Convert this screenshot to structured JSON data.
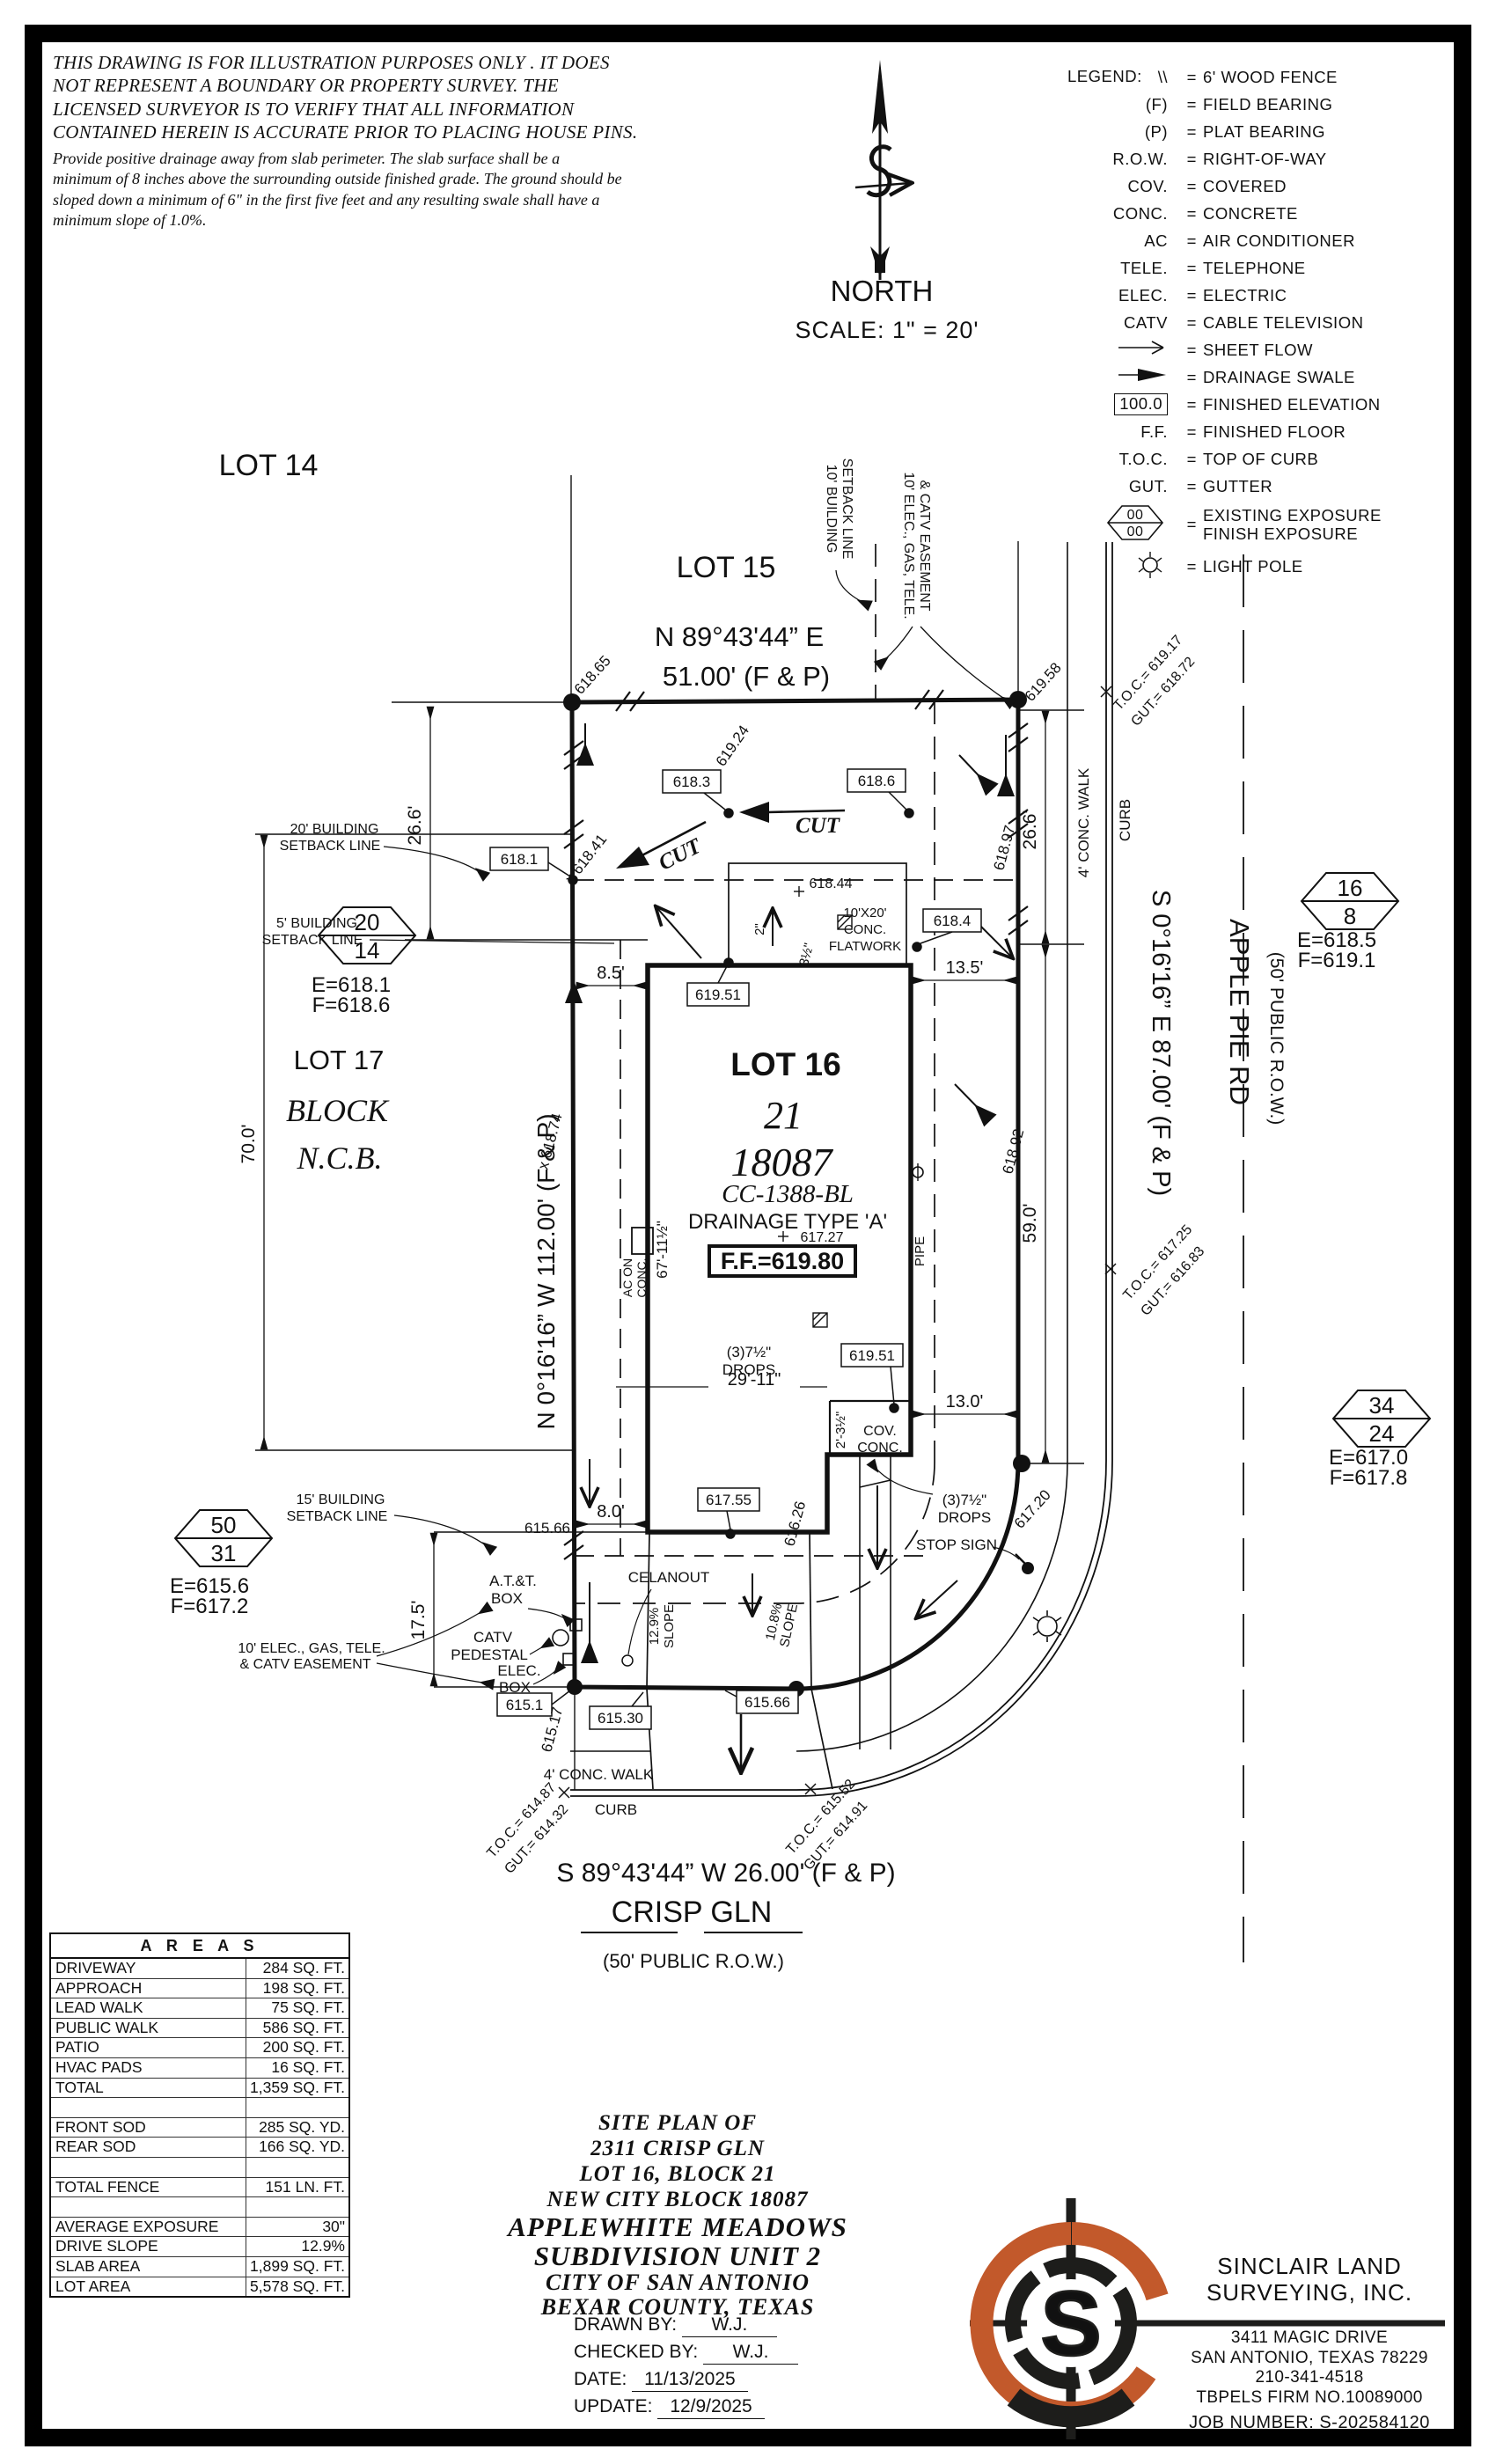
{
  "disclaimer": {
    "para1": "THIS DRAWING IS FOR ILLUSTRATION PURPOSES ONLY . IT DOES\nNOT REPRESENT A BOUNDARY OR PROPERTY SURVEY. THE\nLICENSED SURVEYOR IS TO VERIFY THAT ALL INFORMATION\nCONTAINED HEREIN IS ACCURATE PRIOR TO PLACING HOUSE PINS.",
    "para2": "Provide positive drainage away from slab perimeter. The slab surface shall be a\nminimum of 8 inches above the surrounding outside finished grade. The ground should be\nsloped down a minimum of 6\" in the first five feet and any resulting swale shall have a\nminimum slope of 1.0%."
  },
  "north": {
    "label": "NORTH",
    "scale": "SCALE: 1\" = 20'"
  },
  "legend": {
    "title": "LEGEND:",
    "eq": "=",
    "items": [
      {
        "sym": "\\\\",
        "desc": "6' WOOD FENCE"
      },
      {
        "sym": "(F)",
        "desc": "FIELD BEARING"
      },
      {
        "sym": "(P)",
        "desc": "PLAT BEARING"
      },
      {
        "sym": "R.O.W.",
        "desc": "RIGHT-OF-WAY"
      },
      {
        "sym": "COV.",
        "desc": "COVERED"
      },
      {
        "sym": "CONC.",
        "desc": "CONCRETE"
      },
      {
        "sym": "AC",
        "desc": "AIR CONDITIONER"
      },
      {
        "sym": "TELE.",
        "desc": "TELEPHONE"
      },
      {
        "sym": "ELEC.",
        "desc": "ELECTRIC"
      },
      {
        "sym": "CATV",
        "desc": "CABLE TELEVISION"
      },
      {
        "sym": "",
        "desc": "SHEET FLOW"
      },
      {
        "sym": "",
        "desc": "DRAINAGE SWALE"
      },
      {
        "sym": "100.0",
        "desc": "FINISHED ELEVATION"
      },
      {
        "sym": "F.F.",
        "desc": "FINISHED FLOOR"
      },
      {
        "sym": "T.O.C.",
        "desc": "TOP OF CURB"
      },
      {
        "sym": "GUT.",
        "desc": "GUTTER"
      },
      {
        "sym": "00",
        "sym2": "00",
        "desc": "EXISTING EXPOSURE",
        "desc2": "FINISH EXPOSURE"
      },
      {
        "sym": "",
        "desc": "LIGHT POLE"
      }
    ]
  },
  "plan": {
    "lot14": "LOT 14",
    "lot15": "LOT 15",
    "lot17": "LOT 17",
    "block_word": "BLOCK",
    "ncb_word": "N.C.B.",
    "lot16": "LOT 16",
    "block_num": "21",
    "ncb_num": "18087",
    "cc": "CC-1388-BL",
    "drainage_type": "DRAINAGE TYPE 'A'",
    "ff_spot": "617.27",
    "ff_box": "F.F.=619.80",
    "bearing_top1": "N 89°43'44” E",
    "bearing_top2": "51.00' (F & P)",
    "bearing_left": "N 0°16'16” W  112.00' (F & P)",
    "bearing_right": "S 0°16'16” E 87.00' (F & P)",
    "bearing_bottom": "S 89°43'44” W 26.00' (F & P)",
    "street_right1": "APPLE PIE RD",
    "street_right2": "(50' PUBLIC R.O.W.)",
    "street_bottom1": "CRISP GLN",
    "street_bottom2": "(50' PUBLIC R.O.W.)",
    "setback20_l1": "20' BUILDING",
    "setback20_l2": "SETBACK LINE",
    "setback5_l1": "5' BUILDING",
    "setback5_l2": "SETBACK LINE",
    "setback15_l1": "15' BUILDING",
    "setback15_l2": "SETBACK LINE",
    "setback10_l1": "10' BUILDING",
    "setback10_l2": "SETBACK LINE",
    "easement_top_l1": "10' ELEC., GAS, TELE.",
    "easement_top_l2": "& CATV EASEMENT",
    "easement_bottom_l1": "10' ELEC., GAS, TELE.",
    "easement_bottom_l2": "& CATV EASEMENT",
    "hex1_top": "20",
    "hex1_bot": "14",
    "hex1_e": "E=618.1",
    "hex1_f": "F=618.6",
    "hex2_top": "16",
    "hex2_bot": "8",
    "hex2_e": "E=618.5",
    "hex2_f": "F=619.1",
    "hex3_top": "34",
    "hex3_bot": "24",
    "hex3_e": "E=617.0",
    "hex3_f": "F=617.8",
    "hex4_top": "50",
    "hex4_bot": "31",
    "hex4_e": "E=615.6",
    "hex4_f": "F=617.2",
    "dim_26_6_left": "26.6'",
    "dim_26_6_right": "26.6'",
    "dim_70": "70.0'",
    "dim_59": "59.0'",
    "dim_17_5": "17.5'",
    "dim_8_5": "8.5'",
    "dim_13_5": "13.5'",
    "dim_8_0": "8.0'",
    "dim_13_0": "13.0'",
    "dim_29_11": "29'-11\"",
    "dim_67": "67'-11½\"",
    "dim_cov": "2'-3½\"",
    "flat_2": "2\"",
    "flat_3h": "3½\"",
    "el_618_65": "618.65",
    "el_619_58": "619.58",
    "el_619_24": "619.24",
    "el_618_41": "x 618.41",
    "el_618_97": "618.97",
    "el_618_74": "x 618.74",
    "el_618_92": "618.92",
    "el_618_44": "618.44",
    "el_616_26": "616.26",
    "el_617_20": "617.20",
    "el_615_17": "615.17",
    "el_615_66_txt": "615.66",
    "box_618_1": "618.1",
    "box_618_3": "618.3",
    "box_618_6": "618.6",
    "box_618_4": "618.4",
    "box_619_51a": "619.51",
    "box_619_51b": "619.51",
    "box_617_55": "617.55",
    "box_615_1": "615.1",
    "box_615_30": "615.30",
    "box_615_66": "615.66",
    "toc_tr1": "T.O.C.= 619.17",
    "toc_tr2": "GUT.= 618.72",
    "toc_r1": "T.O.C.= 617.25",
    "toc_r2": "GUT.= 616.83",
    "toc_bl1": "T.O.C.= 614.87",
    "toc_bl2": "GUT.= 614.32",
    "toc_br1": "T.O.C.= 615.52",
    "toc_br2": "GUT.= 614.91",
    "cut1": "CUT",
    "cut2": "CUT",
    "flatwork_l1": "10'X20'",
    "flatwork_l2": "CONC.",
    "flatwork_l3": "FLATWORK",
    "drops1_l1": "(3)7½\"",
    "drops1_l2": "DROPS",
    "drops2_l1": "(3)7½\"",
    "drops2_l2": "DROPS",
    "covconc_l1": "COV.",
    "covconc_l2": "CONC.",
    "ac_l1": "AC ON",
    "ac_l2": "CONC.",
    "pipe": "PIPE",
    "att_l1": "A.T.&T.",
    "att_l2": "BOX",
    "catv_l1": "CATV",
    "catv_l2": "PEDESTAL",
    "elec_l1": "ELEC.",
    "elec_l2": "BOX",
    "cleanout": "CELANOUT",
    "stopsign": "STOP SIGN",
    "slope1_l1": "12.9%",
    "slope1_l2": "SLOPE",
    "slope2_l1": "10.8%",
    "slope2_l2": "SLOPE",
    "walk_right": "4' CONC. WALK",
    "curb_right": "CURB",
    "walk_bottom": "4' CONC. WALK",
    "curb_bottom": "CURB"
  },
  "areas": {
    "header": "A R E A S",
    "rows": [
      {
        "label": "DRIVEWAY",
        "value": "284 SQ. FT."
      },
      {
        "label": "APPROACH",
        "value": "198 SQ. FT."
      },
      {
        "label": "LEAD WALK",
        "value": "75 SQ. FT."
      },
      {
        "label": "PUBLIC WALK",
        "value": "586 SQ. FT."
      },
      {
        "label": "PATIO",
        "value": "200 SQ. FT."
      },
      {
        "label": "HVAC PADS",
        "value": "16 SQ. FT."
      },
      {
        "label": "TOTAL",
        "value": "1,359 SQ. FT."
      },
      {
        "label": "",
        "value": ""
      },
      {
        "label": "FRONT SOD",
        "value": "285 SQ. YD."
      },
      {
        "label": "REAR SOD",
        "value": "166 SQ. YD."
      },
      {
        "label": "",
        "value": ""
      },
      {
        "label": "TOTAL FENCE",
        "value": "151 LN. FT."
      },
      {
        "label": "",
        "value": ""
      },
      {
        "label": "AVERAGE EXPOSURE",
        "value": "30\""
      },
      {
        "label": "DRIVE SLOPE",
        "value": "12.9%"
      },
      {
        "label": "SLAB AREA",
        "value": "1,899 SQ. FT."
      },
      {
        "label": "LOT AREA",
        "value": "5,578 SQ. FT."
      }
    ]
  },
  "titleblock": {
    "line1": "SITE PLAN OF",
    "line2": "2311 CRISP GLN",
    "line3": "LOT 16, BLOCK 21",
    "line4": "NEW CITY BLOCK 18087",
    "line5": "APPLEWHITE MEADOWS",
    "line6": "SUBDIVISION UNIT 2",
    "line7": "CITY OF SAN ANTONIO",
    "line8": "BEXAR COUNTY, TEXAS",
    "drawn_label": "DRAWN BY:",
    "drawn": "W.J.",
    "checked_label": "CHECKED BY:",
    "checked": "W.J.",
    "date_label": "DATE:",
    "date": "11/13/2025",
    "update_label": "UPDATE:",
    "update": "12/9/2025"
  },
  "firm": {
    "name1": "SINCLAIR LAND",
    "name2": "SURVEYING, INC.",
    "addr1": "3411 MAGIC DRIVE",
    "addr2": "SAN ANTONIO, TEXAS 78229",
    "phone": "210-341-4518",
    "firm_no": "TBPELS FIRM NO.10089000",
    "job": "JOB NUMBER:  S-202584120",
    "logo_letter": "S",
    "logo_orange": "#C2592B",
    "logo_black": "#1d1d1b"
  }
}
